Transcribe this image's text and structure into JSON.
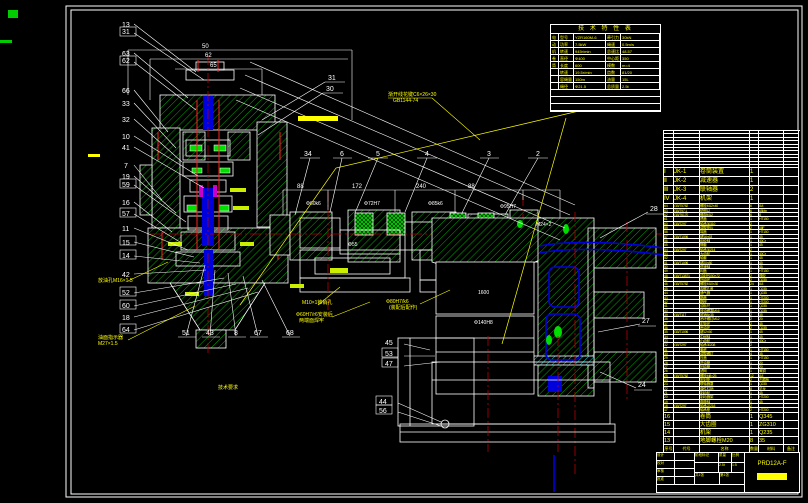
{
  "colors": {
    "bg": "#000000",
    "line": "#ffffff",
    "hatch": "#00a800",
    "bright_green": "#00e000",
    "text_yellow": "#ffff00",
    "centerline_red": "#b40000",
    "shaft_blue": "#0000dd",
    "cyan": "#00cccc",
    "magenta": "#cc00cc"
  },
  "spec_table": {
    "title": "技 术 特 性 表",
    "rows": [
      [
        "电",
        "型号",
        "YZR160M-6",
        "牵引力",
        "30kN"
      ],
      [
        "动",
        "功率",
        "7.5kW",
        "绳速",
        "0.5m/s"
      ],
      [
        "机",
        "转速",
        "945r/min",
        "总速比",
        "48.57"
      ],
      [
        "卷",
        "直径",
        "Φ400",
        "中心距",
        "350"
      ],
      [
        "筒",
        "长度",
        "600",
        "模数",
        "m=4"
      ],
      [
        "",
        "转速",
        "19.5r/min",
        "齿数",
        "81/20"
      ],
      [
        "",
        "容绳量",
        "150m",
        "油量",
        "15L"
      ],
      [
        "",
        "绳径",
        "Φ21.5",
        "总质量",
        "2.5t"
      ]
    ],
    "footer": [
      "钢丝绳 6×19-Φ21.5-1770 GB/T8918-96",
      "润滑油 L-CKC220 GB5903-95",
      "外露表面涂灰色氨基烘漆"
    ]
  },
  "bom": {
    "headers": [
      "序号",
      "代号",
      "名称",
      "数量",
      "材料",
      "备注"
    ],
    "spare_rows": [
      [],
      [],
      [],
      [],
      [],
      [],
      [],
      [],
      [],
      [],
      []
    ],
    "section_rows": [
      [
        "Ⅰ",
        "JK-1",
        "卷筒装置",
        "1",
        "",
        ""
      ],
      [
        "Ⅱ",
        "JK-2",
        "减速器",
        "1",
        "",
        ""
      ],
      [
        "Ⅲ",
        "JK-3",
        "联轴器",
        "2",
        "",
        ""
      ],
      [
        "Ⅳ",
        "JK-4",
        "机架",
        "1",
        "",
        ""
      ]
    ],
    "rows": [
      [
        "64",
        "GB/T5782",
        "螺栓M12×40",
        "6",
        "8.8",
        ""
      ],
      [
        "63",
        "GB/T97.1",
        "垫圈12",
        "6",
        "65Mn",
        ""
      ],
      [
        "62",
        "GB/T6170",
        "螺母M12",
        "6",
        "8",
        ""
      ],
      [
        "61",
        "",
        "透盖",
        "1",
        "HT150",
        ""
      ],
      [
        "60",
        "GB/T297",
        "轴承30310",
        "2",
        "",
        ""
      ],
      [
        "59",
        "",
        "调整垫片",
        "2",
        "08F",
        ""
      ],
      [
        "58",
        "",
        "端盖",
        "1",
        "HT150",
        ""
      ],
      [
        "57",
        "GB/T1096",
        "键16×63",
        "1",
        "45",
        ""
      ],
      [
        "56",
        "",
        "齿轮轴",
        "1",
        "40Cr",
        ""
      ],
      [
        "55",
        "",
        "隔套",
        "1",
        "45",
        ""
      ],
      [
        "54",
        "GB/T297",
        "轴承30214",
        "2",
        "",
        ""
      ],
      [
        "53",
        "",
        "大齿轮",
        "1",
        "40Cr",
        ""
      ],
      [
        "52",
        "",
        "轴套",
        "1",
        "45",
        ""
      ],
      [
        "51",
        "GB/T1096",
        "键20×80",
        "1",
        "45",
        ""
      ],
      [
        "50",
        "",
        "低速轴",
        "1",
        "45",
        ""
      ],
      [
        "49",
        "",
        "闷盖",
        "1",
        "HT150",
        ""
      ],
      [
        "48",
        "GB/T13871",
        "油封PD50×72",
        "2",
        "橡胶",
        ""
      ],
      [
        "47",
        "",
        "挡油环",
        "2",
        "Q235",
        ""
      ],
      [
        "46",
        "GB/T5782",
        "螺栓M10×30",
        "24",
        "8.8",
        ""
      ],
      [
        "45",
        "",
        "观察孔盖",
        "1",
        "Q235",
        ""
      ],
      [
        "44",
        "",
        "通气器",
        "1",
        "Q235",
        ""
      ],
      [
        "43",
        "",
        "箱盖",
        "1",
        "HT200",
        ""
      ],
      [
        "42",
        "",
        "箱座",
        "1",
        "HT200",
        ""
      ],
      [
        "41",
        "",
        "油标尺",
        "1",
        "Q235",
        ""
      ],
      [
        "40",
        "",
        "放油螺塞M16",
        "1",
        "Q235",
        ""
      ],
      [
        "39",
        "GB/T117",
        "锥销8×35",
        "2",
        "35",
        ""
      ],
      [
        "38",
        "",
        "吊环螺钉M12",
        "2",
        "20",
        ""
      ],
      [
        "37",
        "",
        "定距环",
        "2",
        "45",
        ""
      ],
      [
        "36",
        "",
        "甩油环",
        "2",
        "Q235",
        ""
      ],
      [
        "35",
        "GB/T1096",
        "键12×50",
        "1",
        "45",
        ""
      ],
      [
        "34",
        "",
        "中间轴",
        "1",
        "45",
        ""
      ],
      [
        "33",
        "",
        "小齿轮",
        "1",
        "40Cr",
        ""
      ],
      [
        "32",
        "GB/T297",
        "轴承30208",
        "2",
        "",
        ""
      ],
      [
        "31",
        "",
        "套杯",
        "1",
        "HT150",
        ""
      ],
      [
        "30",
        "",
        "调整螺钉",
        "4",
        "35",
        ""
      ],
      [
        "29",
        "",
        "压盖",
        "1",
        "HT150",
        ""
      ],
      [
        "28",
        "",
        "进油管",
        "1",
        "20",
        ""
      ],
      [
        "27",
        "",
        "回油管",
        "1",
        "20",
        ""
      ],
      [
        "26",
        "",
        "滤网",
        "1",
        "黄铜",
        ""
      ],
      [
        "25",
        "GB/T5782",
        "螺栓M8×25",
        "12",
        "8.8",
        ""
      ],
      [
        "24",
        "",
        "密封垫",
        "2",
        "石棉板",
        ""
      ],
      [
        "23",
        "",
        "联轴器罩",
        "1",
        "Q235",
        ""
      ],
      [
        "22",
        "",
        "弹性柱销",
        "8",
        "尼龙",
        ""
      ],
      [
        "21",
        "",
        "制动轮",
        "1",
        "45",
        ""
      ],
      [
        "20",
        "",
        "制动器架",
        "1",
        "HT200",
        ""
      ],
      [
        "19",
        "",
        "卷筒轴",
        "1",
        "45",
        ""
      ],
      [
        "18",
        "GB/T297",
        "轴承22218",
        "2",
        "",
        ""
      ],
      [
        "17",
        "",
        "轴承座",
        "2",
        "HT200",
        ""
      ]
    ],
    "footer_rows": [
      [
        "16",
        "",
        "卷筒",
        "1",
        "Q345",
        ""
      ],
      [
        "15",
        "",
        "大齿圈",
        "1",
        "ZG310",
        ""
      ],
      [
        "14",
        "",
        "机架",
        "1",
        "Q235",
        ""
      ],
      [
        "13",
        "",
        "地脚螺栓M20",
        "8",
        "35",
        ""
      ]
    ]
  },
  "title_block": {
    "sign_labels": [
      "设计",
      "校对",
      "审核",
      "批准"
    ],
    "stage_label": "阶段标记",
    "mass_label": "质量",
    "scale_label": "比例",
    "mass_value": "2.5t",
    "scale_value": "1:5",
    "sheet_total": "共1张",
    "sheet_no": "第1张",
    "code": "PRD12A-F"
  },
  "notes": {
    "title": "技术要求",
    "lines": [
      "1.装配前所有零件用煤油清洗,滚动轴承用汽油清洗干净;",
      "2.啮合侧隙用铅丝检验,侧隙不得小于0.16mm,铅丝不得大于最小侧隙4倍;",
      "3.涂色法检验齿面接触斑点,按齿高不小于40%,按齿长不小于50%;",
      "4.减速器剖分面涂密封胶,不允许使用任何垫片;",
      "5.装配后空载试验正反转各1小时,运转平稳无异常振动。"
    ]
  },
  "drawing": {
    "left_callouts": [
      "13",
      "31",
      "63",
      "62",
      "66",
      "33",
      "32",
      "10",
      "41",
      "7",
      "19",
      "59",
      "16",
      "57",
      "11",
      "15",
      "14",
      "42",
      "52",
      "60",
      "18",
      "64"
    ],
    "top_callouts": [
      "34",
      "6",
      "5",
      "4",
      "3",
      "2"
    ],
    "bottom_callouts": [
      "51",
      "43",
      "8",
      "67",
      "68"
    ],
    "right_callouts": [
      "28",
      "27",
      "24"
    ],
    "mid_callouts": [
      "45",
      "53",
      "47",
      "44",
      "56"
    ],
    "misc_callouts": [
      "31",
      "30"
    ],
    "dims": {
      "stack": [
        "50",
        "62",
        "65"
      ],
      "chain": [
        "88",
        "172",
        "240",
        "88"
      ],
      "fits": [
        "Φ60k6",
        "Φ72H7",
        "Φ85k6",
        "Φ95H7",
        "M24×2",
        "Φ140H8",
        "1600",
        "Φ55"
      ]
    },
    "annotations": {
      "spline1": "渐开线花键C6×26×30",
      "spline2": "GB1144-74",
      "pin": "M10×1锥销孔",
      "fit1a": "Φ80H7/k6",
      "fit1b": "(装配后配作)",
      "fit2a": "Φ60H7/r6安装后",
      "fit2b": "两端面焊牢",
      "drain": "放油孔M16×1.5",
      "oil1": "油面指示器",
      "oil2": "M27×1.5"
    }
  }
}
